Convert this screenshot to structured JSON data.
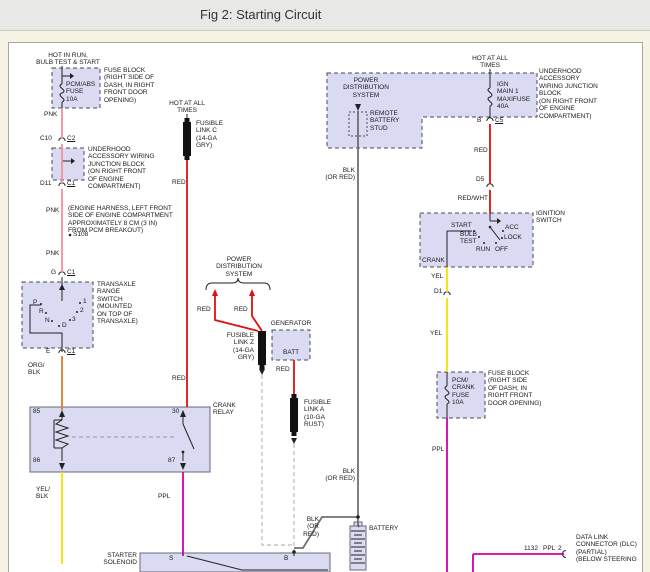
{
  "window": {
    "title": "Fig 2: Starting Circuit"
  },
  "colors": {
    "page_bg": "#F5F4E4",
    "titlebar_bg": "#E8E8E6",
    "canvas_bg": "#FFFFFF",
    "box_fill": "#DADAF3",
    "wire_pnk": "#F2909E",
    "wire_red": "#E01010",
    "wire_org_blk": "#D87C30",
    "wire_yel": "#F2E400",
    "wire_ppl": "#CE00A5",
    "wire_blk_or_red": "#707070"
  },
  "labels": {
    "hot_in_run": "HOT IN RUN,\nBULB TEST & START",
    "fuse_block_1_name": "PCM/ABS\nFUSE\n10A",
    "fuse_block_1_note": "FUSE BLOCK\n(RIGHT SIDE OF\nDASH, IN RIGHT\nFRONT DOOR\nOPENING)",
    "pnk_1": "PNK",
    "c10": "C10",
    "c2": "C2",
    "junction_block_note_left": "UNDERHOOD\nACCESSORY WIRING\nJUNCTION BLOCK\n(ON RIGHT FRONT\nOF ENGINE\nCOMPARTMENT)",
    "d11": "D11",
    "c1_a": "C1",
    "pnk_2": "PNK",
    "engine_harness_note": "(ENGINE HARNESS, LEFT FRONT\nSIDE OF ENGINE COMPARTMENT\nAPPROXIMATELY 8 CM (3 IN)\nFROM PCM BREAKOUT)",
    "s108": "S108",
    "pnk_3": "PNK",
    "g": "G",
    "c1_b": "C1",
    "transaxle_note": "TRANSAXLE\nRANGE\nSWITCH\n(MOUNTED\nON TOP OF\nTRANSAXLE)",
    "pos_p": "P",
    "pos_r": "R",
    "pos_n": "N",
    "pos_d": "D",
    "pos_1": "1",
    "pos_2": "2",
    "pos_3": "3",
    "e": "E",
    "c1_c": "C1",
    "org_blk": "ORG/\nBLK",
    "pin_85": "85",
    "pin_30": "30",
    "pin_86": "86",
    "pin_87": "87",
    "crank_relay": "CRANK\nRELAY",
    "yel_blk": "YEL/\nBLK",
    "ppl_1": "PPL",
    "starter_solenoid": "STARTER\nSOLENOID",
    "s_terminal": "S",
    "b_terminal": "B",
    "hot_at_all_times_mid": "HOT AT ALL\nTIMES",
    "fusible_link_c": "FUSIBLE\nLINK C\n(14-GA\nGRY)",
    "red_1": "RED",
    "red_2": "RED",
    "power_dist_mid": "POWER\nDISTRIBUTION\nSYSTEM",
    "red_3": "RED",
    "red_4": "RED",
    "fusible_link_z": "FUSIBLE\nLINK Z\n(14-GA\nGRY)",
    "generator": "GENERATOR",
    "batt": "BATT",
    "red_5": "RED",
    "fusible_link_a": "FUSIBLE\nLINK A\n(10-GA\nRUST)",
    "blk_or_red_1": "BLK\n(OR RED)",
    "blk_or_red_2": "BLK\n(OR RED)",
    "blk_or_red_3": "BLK\n(OR\nRED)",
    "battery": "BATTERY",
    "battery_plus": "+",
    "power_dist_top": "POWER\nDISTRIBUTION\nSYSTEM",
    "remote_stud": "REMOTE\nBATTERY\nSTUD",
    "hot_at_all_times_right": "HOT AT ALL\nTIMES",
    "ign_main_fuse": "IGN\nMAIN 1\nMAXIFUSE\n40A",
    "junction_block_note_right": "UNDERHOOD\nACCESSORY\nWIRING JUNCTION\nBLOCK\n(ON RIGHT FRONT\nOF ENGINE\nCOMPARTMENT)",
    "b_pin": "B",
    "c5": "C5",
    "red_6": "RED",
    "d5": "D5",
    "red_wht": "RED/WHT",
    "ignition_switch": "IGNITION\nSWITCH",
    "ign_start": "START",
    "ign_bulb_test": "BULB\nTEST",
    "ign_run": "RUN",
    "ign_off": "OFF",
    "ign_lock": "LOCK",
    "ign_acc": "ACC",
    "crank": "CRANK",
    "yel_1": "YEL",
    "d1": "D1",
    "yel_2": "YEL",
    "pcm_crank_fuse": "PCM/\nCRANK\nFUSE\n10A",
    "fuse_block_2_note": "FUSE BLOCK\n(RIGHT SIDE\nOF DASH, IN\nRIGHT FRONT\nDOOR OPENING)",
    "ppl_2": "PPL",
    "dlc_circuit": "1132",
    "dlc_color": "PPL",
    "dlc_pin": "2",
    "dlc_note": "DATA LINK\nCONNECTOR (DLC)\n(PARTIAL)\n(BELOW STEERING"
  }
}
